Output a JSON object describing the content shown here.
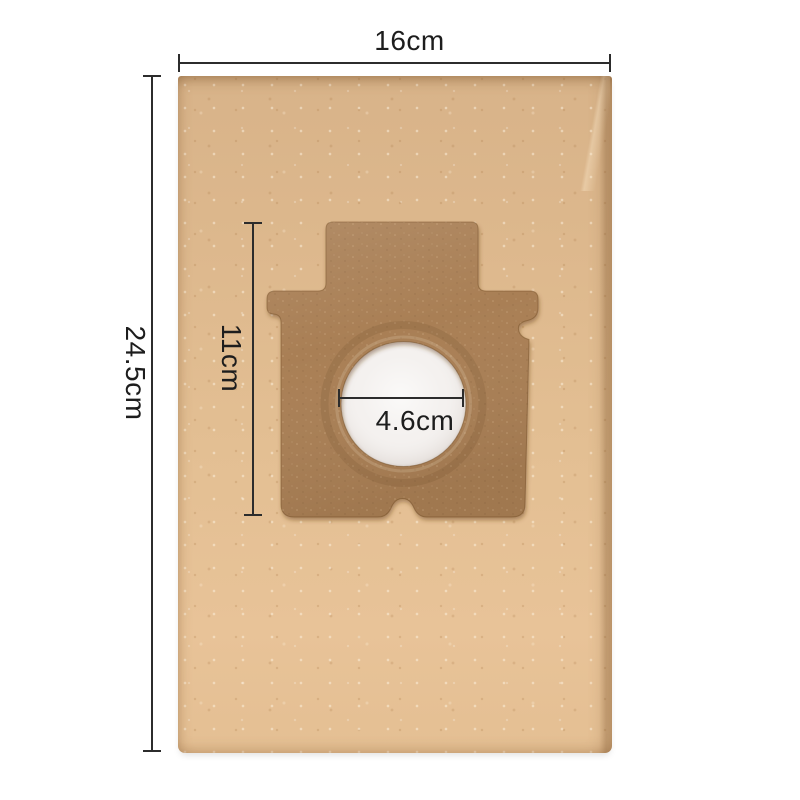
{
  "dimensions": {
    "bag_width": "16cm",
    "bag_height": "24.5cm",
    "plate_height": "11cm",
    "hole_diameter": "4.6cm"
  },
  "colors": {
    "background": "#ffffff",
    "bag": "#e0bb8f",
    "plate": "#a97f54",
    "plate_edge": "#6f4a22",
    "tissue": "#f4f1ef",
    "dim_line": "#2c2c2c",
    "dim_text": "#1d1d1d"
  }
}
